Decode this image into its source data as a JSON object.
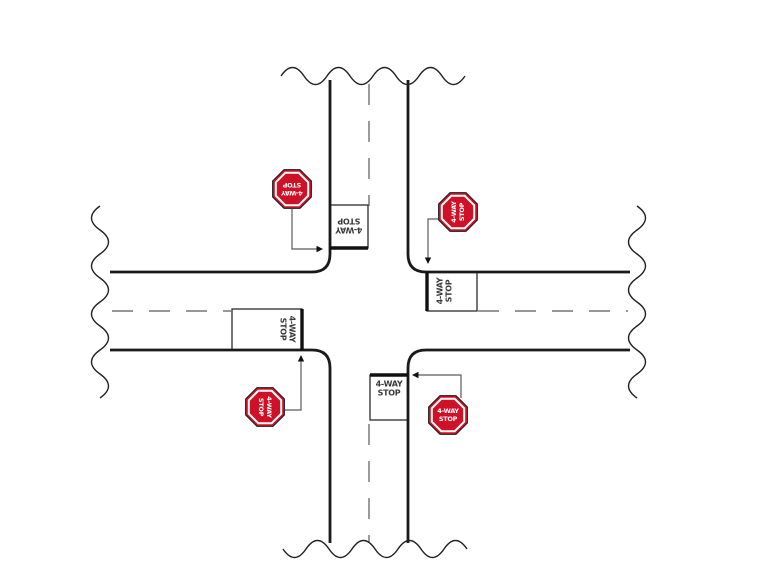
{
  "colors": {
    "sign_red": "#ce1126",
    "road_line": "#1a1a1a",
    "centerline_gray": "#8a8a8a",
    "leader_gray": "#5a5a5a",
    "label_text": "#3a3a3a"
  },
  "signs": {
    "northwest": {
      "line1": "4-WAY",
      "line2": "STOP"
    },
    "northeast": {
      "line1": "4-WAY",
      "line2": "STOP"
    },
    "southwest": {
      "line1": "4-WAY",
      "line2": "STOP"
    },
    "southeast": {
      "line1": "4-WAY",
      "line2": "STOP"
    }
  },
  "stop_line_labels": {
    "north": {
      "line1": "4-WAY",
      "line2": "STOP"
    },
    "east": {
      "line1": "4-WAY",
      "line2": "STOP"
    },
    "south": {
      "line1": "4-WAY",
      "line2": "STOP"
    },
    "west": {
      "line1": "4-WAY",
      "line2": "STOP"
    }
  }
}
